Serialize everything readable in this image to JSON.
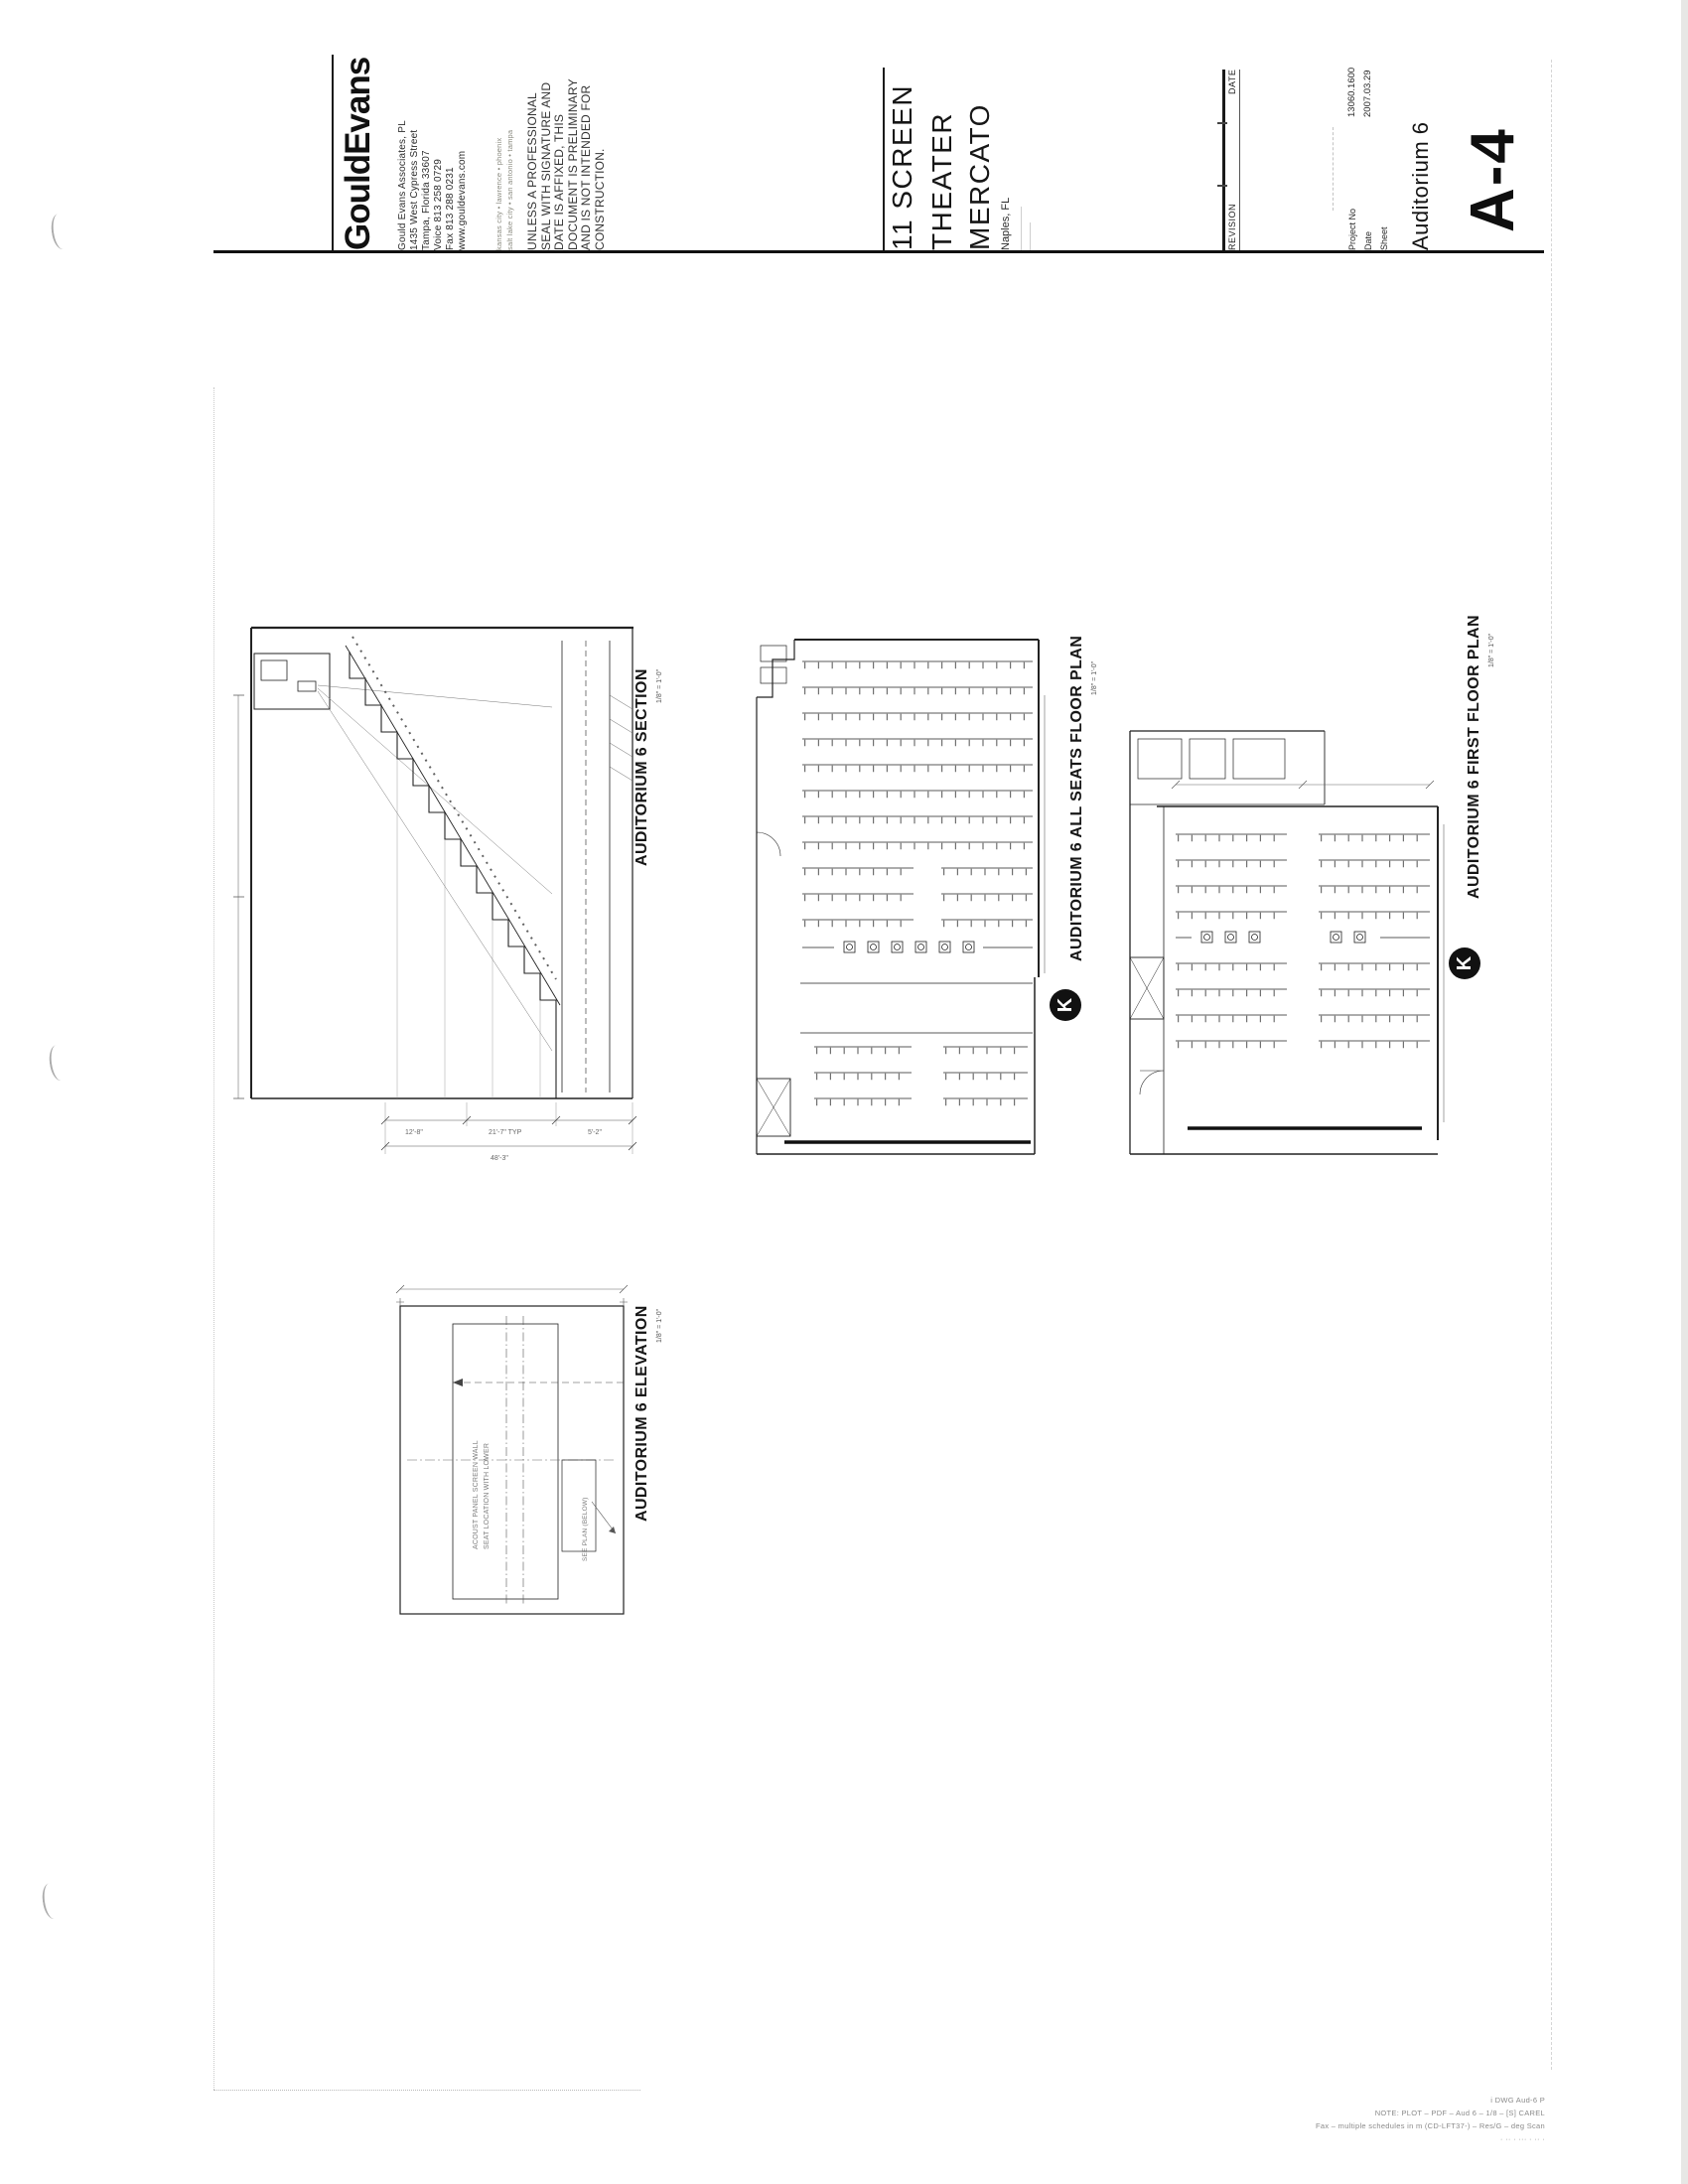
{
  "firm": {
    "logo": "GouldEvans",
    "address_lines": [
      "Gould Evans Associates, PL",
      "1435 West Cypress Street",
      "Tampa, Florida 33607",
      "Voice 813 258 0729",
      "Fax 813 288 0231",
      "www.gouldevans.com"
    ],
    "office_lines": [
      "kansas city • lawrence • phoenix",
      "salt lake city • san antonio • tampa"
    ],
    "disclaimer_lines": [
      "UNLESS A PROFESSIONAL",
      "SEAL WITH SIGNATURE AND",
      "DATE IS AFFIXED, THIS",
      "DOCUMENT IS PRELIMINARY",
      "AND IS NOT INTENDED FOR",
      "CONSTRUCTION."
    ]
  },
  "project": {
    "title_line1": "11 SCREEN",
    "title_line2": "THEATER",
    "title_line3": "MERCATO",
    "location": "Naples, FL"
  },
  "revision": {
    "revision_label": "REVISION",
    "date_label": "DATE"
  },
  "titleblock": {
    "project_no_label": "Project No",
    "project_no": "13060.1600",
    "date_label": "Date",
    "date": "2007.03.29",
    "sheet_label": "Sheet",
    "sheet_title": "Auditorium 6",
    "sheet_number": "A-4"
  },
  "drawings": {
    "section": {
      "title": "AUDITORIUM 6 SECTION",
      "scale": "1/8\" = 1'-0\"",
      "dim1": "12'-8\"",
      "dim2": "21'-7\" TYP",
      "dim3": "5'-2\"",
      "dim_total": "48'-3\""
    },
    "all_seats": {
      "title": "AUDITORIUM 6 ALL SEATS FLOOR PLAN",
      "scale": "1/8\" = 1'-0\"",
      "mark": "K"
    },
    "first_floor": {
      "title": "AUDITORIUM 6 FIRST FLOOR PLAN",
      "scale": "1/8\" = 1'-0\"",
      "mark": "K"
    },
    "elevation": {
      "title": "AUDITORIUM 6 ELEVATION",
      "scale": "1/8\" = 1'-0\"",
      "note_line1": "ACOUST PANEL SCREEN WALL",
      "note_line2": "SEAT LOCATION WITH LOWER",
      "note_line3": "SEE PLAN (BELOW)"
    }
  },
  "footer": {
    "line1": "i DWG Aud-6 P",
    "line2": "NOTE: PLOT – PDF – Aud 6 – 1/8 – [S] CAREL",
    "line3": "Fax – multiple schedules in m (CD-LFT37-) – Res/G – deg Scan",
    "line4": "· ·· · ··· · ·· ·"
  }
}
